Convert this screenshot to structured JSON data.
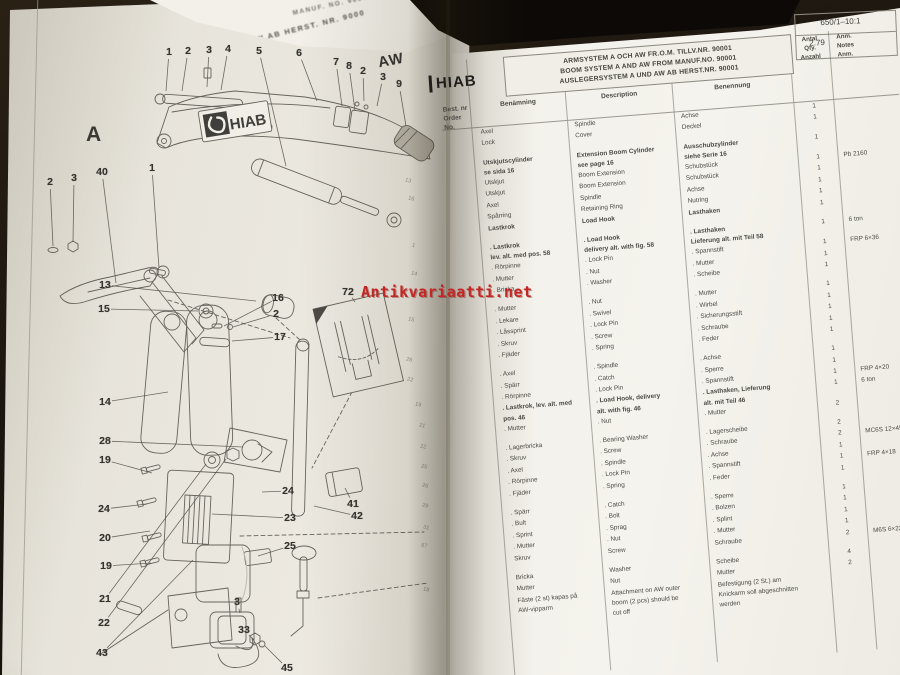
{
  "watermark": {
    "text": "Antikvariaatti.net",
    "color": "#c32724"
  },
  "curled_page": {
    "fragment_top": "MANUF. NO. 9000",
    "fragment_bottom": "AW AB HERST. NR. 9000"
  },
  "left_page": {
    "section_label_a": "A",
    "section_label_aw": "AW",
    "logo": "HIAB",
    "callouts": [
      {
        "n": "1",
        "x": 169,
        "y": 52,
        "lx": 166,
        "ly": 91
      },
      {
        "n": "2",
        "x": 188,
        "y": 51,
        "lx": 182,
        "ly": 91
      },
      {
        "n": "3",
        "x": 209,
        "y": 50,
        "lx": 207,
        "ly": 87
      },
      {
        "n": "4",
        "x": 228,
        "y": 49,
        "lx": 221,
        "ly": 90
      },
      {
        "n": "5",
        "x": 259,
        "y": 51,
        "lx": 286,
        "ly": 166
      },
      {
        "n": "6",
        "x": 299,
        "y": 53,
        "lx": 317,
        "ly": 101
      },
      {
        "n": "7",
        "x": 336,
        "y": 62,
        "lx": 342,
        "ly": 106
      },
      {
        "n": "8",
        "x": 349,
        "y": 66,
        "lx": 355,
        "ly": 111
      },
      {
        "n": "2",
        "x": 363,
        "y": 71,
        "lx": 364,
        "ly": 101
      },
      {
        "n": "3",
        "x": 383,
        "y": 77,
        "lx": 377,
        "ly": 106
      },
      {
        "n": "9",
        "x": 399,
        "y": 84,
        "lx": 406,
        "ly": 126
      },
      {
        "n": "2",
        "x": 50,
        "y": 182,
        "lx": 53,
        "ly": 246
      },
      {
        "n": "3",
        "x": 74,
        "y": 178,
        "lx": 73,
        "ly": 242
      },
      {
        "n": "40",
        "x": 102,
        "y": 172,
        "lx": 116,
        "ly": 283
      },
      {
        "n": "1",
        "x": 152,
        "y": 168,
        "lx": 159,
        "ly": 268
      },
      {
        "n": "13",
        "x": 105,
        "y": 285,
        "lx": 256,
        "ly": 301
      },
      {
        "n": "15",
        "x": 104,
        "y": 309,
        "lx": 198,
        "ly": 311
      },
      {
        "n": "16",
        "x": 278,
        "y": 298,
        "lx": 224,
        "ly": 326
      },
      {
        "n": "2",
        "x": 276,
        "y": 314,
        "lx": 233,
        "ly": 327
      },
      {
        "n": "17",
        "x": 280,
        "y": 337,
        "lx": 232,
        "ly": 341
      },
      {
        "n": "14",
        "x": 105,
        "y": 402,
        "lx": 168,
        "ly": 392
      },
      {
        "n": "72",
        "x": 348,
        "y": 292,
        "lx": 355,
        "ly": 302
      },
      {
        "n": "28",
        "x": 105,
        "y": 441,
        "lx": 243,
        "ly": 447
      },
      {
        "n": "19",
        "x": 105,
        "y": 460,
        "lx": 152,
        "ly": 473
      },
      {
        "n": "24",
        "x": 104,
        "y": 509,
        "lx": 147,
        "ly": 504
      },
      {
        "n": "20",
        "x": 105,
        "y": 538,
        "lx": 150,
        "ly": 531
      },
      {
        "n": "19",
        "x": 106,
        "y": 566,
        "lx": 151,
        "ly": 563
      },
      {
        "n": "21",
        "x": 105,
        "y": 599,
        "lx": 206,
        "ly": 464
      },
      {
        "n": "22",
        "x": 104,
        "y": 623,
        "lx": 226,
        "ly": 459
      },
      {
        "n": "43",
        "x": 102,
        "y": 653,
        "lx": 193,
        "ly": 560
      },
      {
        "n": "24",
        "x": 288,
        "y": 491,
        "lx": 262,
        "ly": 492
      },
      {
        "n": "23",
        "x": 290,
        "y": 518,
        "lx": 212,
        "ly": 514
      },
      {
        "n": "25",
        "x": 290,
        "y": 546,
        "lx": 258,
        "ly": 556
      },
      {
        "n": "41",
        "x": 353,
        "y": 504,
        "lx": 345,
        "ly": 488
      },
      {
        "n": "42",
        "x": 357,
        "y": 516,
        "lx": 314,
        "ly": 506
      },
      {
        "n": "3",
        "x": 237,
        "y": 602,
        "lx": 240,
        "ly": 613
      },
      {
        "n": "33",
        "x": 244,
        "y": 630,
        "lx": 254,
        "ly": 640
      },
      {
        "n": "45",
        "x": 287,
        "y": 668,
        "lx": 265,
        "ly": 646
      }
    ],
    "spine_numbers": [
      {
        "n": "13",
        "x": 405,
        "y": 178
      },
      {
        "n": "16",
        "x": 408,
        "y": 196
      },
      {
        "n": "1",
        "x": 412,
        "y": 243
      },
      {
        "n": "14",
        "x": 411,
        "y": 271
      },
      {
        "n": "15",
        "x": 408,
        "y": 317
      },
      {
        "n": "26",
        "x": 406,
        "y": 357
      },
      {
        "n": "22",
        "x": 407,
        "y": 377
      },
      {
        "n": "19",
        "x": 415,
        "y": 402
      },
      {
        "n": "21",
        "x": 419,
        "y": 423
      },
      {
        "n": "22",
        "x": 420,
        "y": 444
      },
      {
        "n": "25",
        "x": 421,
        "y": 464
      },
      {
        "n": "26",
        "x": 422,
        "y": 483
      },
      {
        "n": "29",
        "x": 422,
        "y": 503
      },
      {
        "n": "31",
        "x": 423,
        "y": 525
      },
      {
        "n": "57",
        "x": 421,
        "y": 543
      },
      {
        "n": "18",
        "x": 423,
        "y": 587
      }
    ]
  },
  "right_page": {
    "logo": "HIAB",
    "ref": {
      "code": "650/1–10:1",
      "issue": "2.79"
    },
    "titles": [
      "ARMSYSTEM A OCH AW FR.O.M. TILLV.NR. 90001",
      "BOOM SYSTEM A AND AW FROM MANUF.NO. 90001",
      "AUSLEGERSYSTEM A UND AW AB HERST.NR. 90001"
    ],
    "order_col_header": "Best. nr\nOrder No.\nBest. Nr",
    "headers": {
      "sv": "Benämning",
      "en": "Description",
      "de": "Benennung",
      "qty": "Antal\nQty.\nAnzahl",
      "note": "Anm.\nNotes\nAnm."
    },
    "rows": [
      {
        "sv": "Axel",
        "en": "Spindle",
        "de": "Achse",
        "qty": "1"
      },
      {
        "sv": "Lock",
        "en": "Cover",
        "de": "Deckel",
        "qty": "1"
      },
      {
        "gap": true
      },
      {
        "sv": "Utskjutscylinder\nse sida 16",
        "en": "Extension Boom Cylinder\nsee page 16",
        "de": "Ausschubzylinder\nsiehe Serie 16",
        "qty": "1",
        "bold": true
      },
      {
        "sv": "Utskjut",
        "en": "Boom Extension",
        "de": "Schubstück",
        "qty": "1",
        "note": "Pb 2160"
      },
      {
        "sv": "Utskjut",
        "en": "Boom Extension",
        "de": "Schubstück",
        "qty": "1"
      },
      {
        "sv": "Axel",
        "en": "Spindle",
        "de": "Achse",
        "qty": "1"
      },
      {
        "sv": "Spårring",
        "en": "Retaining Ring",
        "de": "Nutring",
        "qty": "1"
      },
      {
        "sv": "Lastkrok",
        "en": "Load Hook",
        "de": "Lasthaken",
        "qty": "1",
        "bold": true
      },
      {
        "gap": true
      },
      {
        "sv": ". Lastkrok\nlev. alt. med pos. 58",
        "en": ". Load Hook\ndelivery alt. with fig. 58",
        "de": ". Lasthaken\nLieferung alt. mit Teil 58",
        "qty": "1",
        "note": "6 ton",
        "bold": true
      },
      {
        "sv": ". Rörpinne",
        "en": ". Lock Pin",
        "de": ". Spannstift",
        "qty": "1",
        "note": "FRP 6×36"
      },
      {
        "sv": ". Mutter",
        "en": ". Nut",
        "de": ". Mutter",
        "qty": "1"
      },
      {
        "sv": ". Bricka",
        "en": ". Washer",
        "de": ". Scheibe",
        "qty": "1"
      },
      {
        "gap": true
      },
      {
        "sv": ". Mutter",
        "en": ". Nut",
        "de": ". Mutter",
        "qty": "1"
      },
      {
        "sv": ". Lekare",
        "en": ". Swivel",
        "de": ". Wirbel",
        "qty": "1"
      },
      {
        "sv": ". Låssprint",
        "en": ". Lock Pin",
        "de": ". Sicherungsstift",
        "qty": "1"
      },
      {
        "sv": ". Skruv",
        "en": ". Screw",
        "de": ". Schraube",
        "qty": "1"
      },
      {
        "sv": ". Fjäder",
        "en": ". Spring",
        "de": ". Feder",
        "qty": "1"
      },
      {
        "gap": true
      },
      {
        "sv": ". Axel",
        "en": ". Spindle",
        "de": ". Achse",
        "qty": "1"
      },
      {
        "sv": ". Spärr",
        "en": ". Catch",
        "de": ". Sperre",
        "qty": "1"
      },
      {
        "sv": ". Rörpinne",
        "en": ". Lock Pin",
        "de": ". Spannstift",
        "qty": "1",
        "note": "FRP 4×20"
      },
      {
        "sv": ". Lastkrok, lev. alt. med\npos. 46",
        "en": ". Load Hook, delivery\nalt. with fig. 46",
        "de": ". Lasthaken, Lieferung\nalt. mit Teil 46",
        "qty": "1",
        "note": "6 ton",
        "bold": true
      },
      {
        "sv": ". Mutter",
        "en": ". Nut",
        "de": ". Mutter",
        "qty": "2"
      },
      {
        "gap": true
      },
      {
        "sv": ". Lagerbricka",
        "en": ". Bearing Washer",
        "de": ". Lagerscheibe",
        "qty": "2"
      },
      {
        "sv": ". Skruv",
        "en": ". Screw",
        "de": ". Schraube",
        "qty": "2",
        "note": "MC6S 12×45"
      },
      {
        "sv": ". Axel",
        "en": ". Spindle",
        "de": ". Achse",
        "qty": "1"
      },
      {
        "sv": ". Rörpinne",
        "en": ". Lock Pin",
        "de": ". Spannstift",
        "qty": "1",
        "note": "FRP 4×18"
      },
      {
        "sv": ". Fjäder",
        "en": ". Spring",
        "de": ". Feder",
        "qty": "1"
      },
      {
        "gap": true
      },
      {
        "sv": ". Spärr",
        "en": ". Catch",
        "de": ". Sperre",
        "qty": "1"
      },
      {
        "sv": ". Bult",
        "en": ". Bolt",
        "de": ". Bolzen",
        "qty": "1"
      },
      {
        "sv": ". Sprint",
        "en": ". Sprag",
        "de": ". Splint",
        "qty": "1"
      },
      {
        "sv": ". Mutter",
        "en": ". Nut",
        "de": ". Mutter",
        "qty": "1"
      },
      {
        "sv": "Skruv",
        "en": "Screw",
        "de": "Schraube",
        "qty": "2",
        "note": "M6S 6×22"
      },
      {
        "gap": true
      },
      {
        "sv": "Bricka",
        "en": "Washer",
        "de": "Scheibe",
        "qty": "4"
      },
      {
        "sv": "Mutter",
        "en": "Nut",
        "de": "Mutter",
        "qty": "2"
      },
      {
        "sv": "Fäste (2 st) kapas på\nAW-vipparm",
        "en": "Attachment on AW outer\nboom (2 pcs) should be\ncut off",
        "de": "Befestigung (2 St.) am\nKnickarm soll abgeschnitten\nwerden",
        "qty": ""
      }
    ]
  }
}
